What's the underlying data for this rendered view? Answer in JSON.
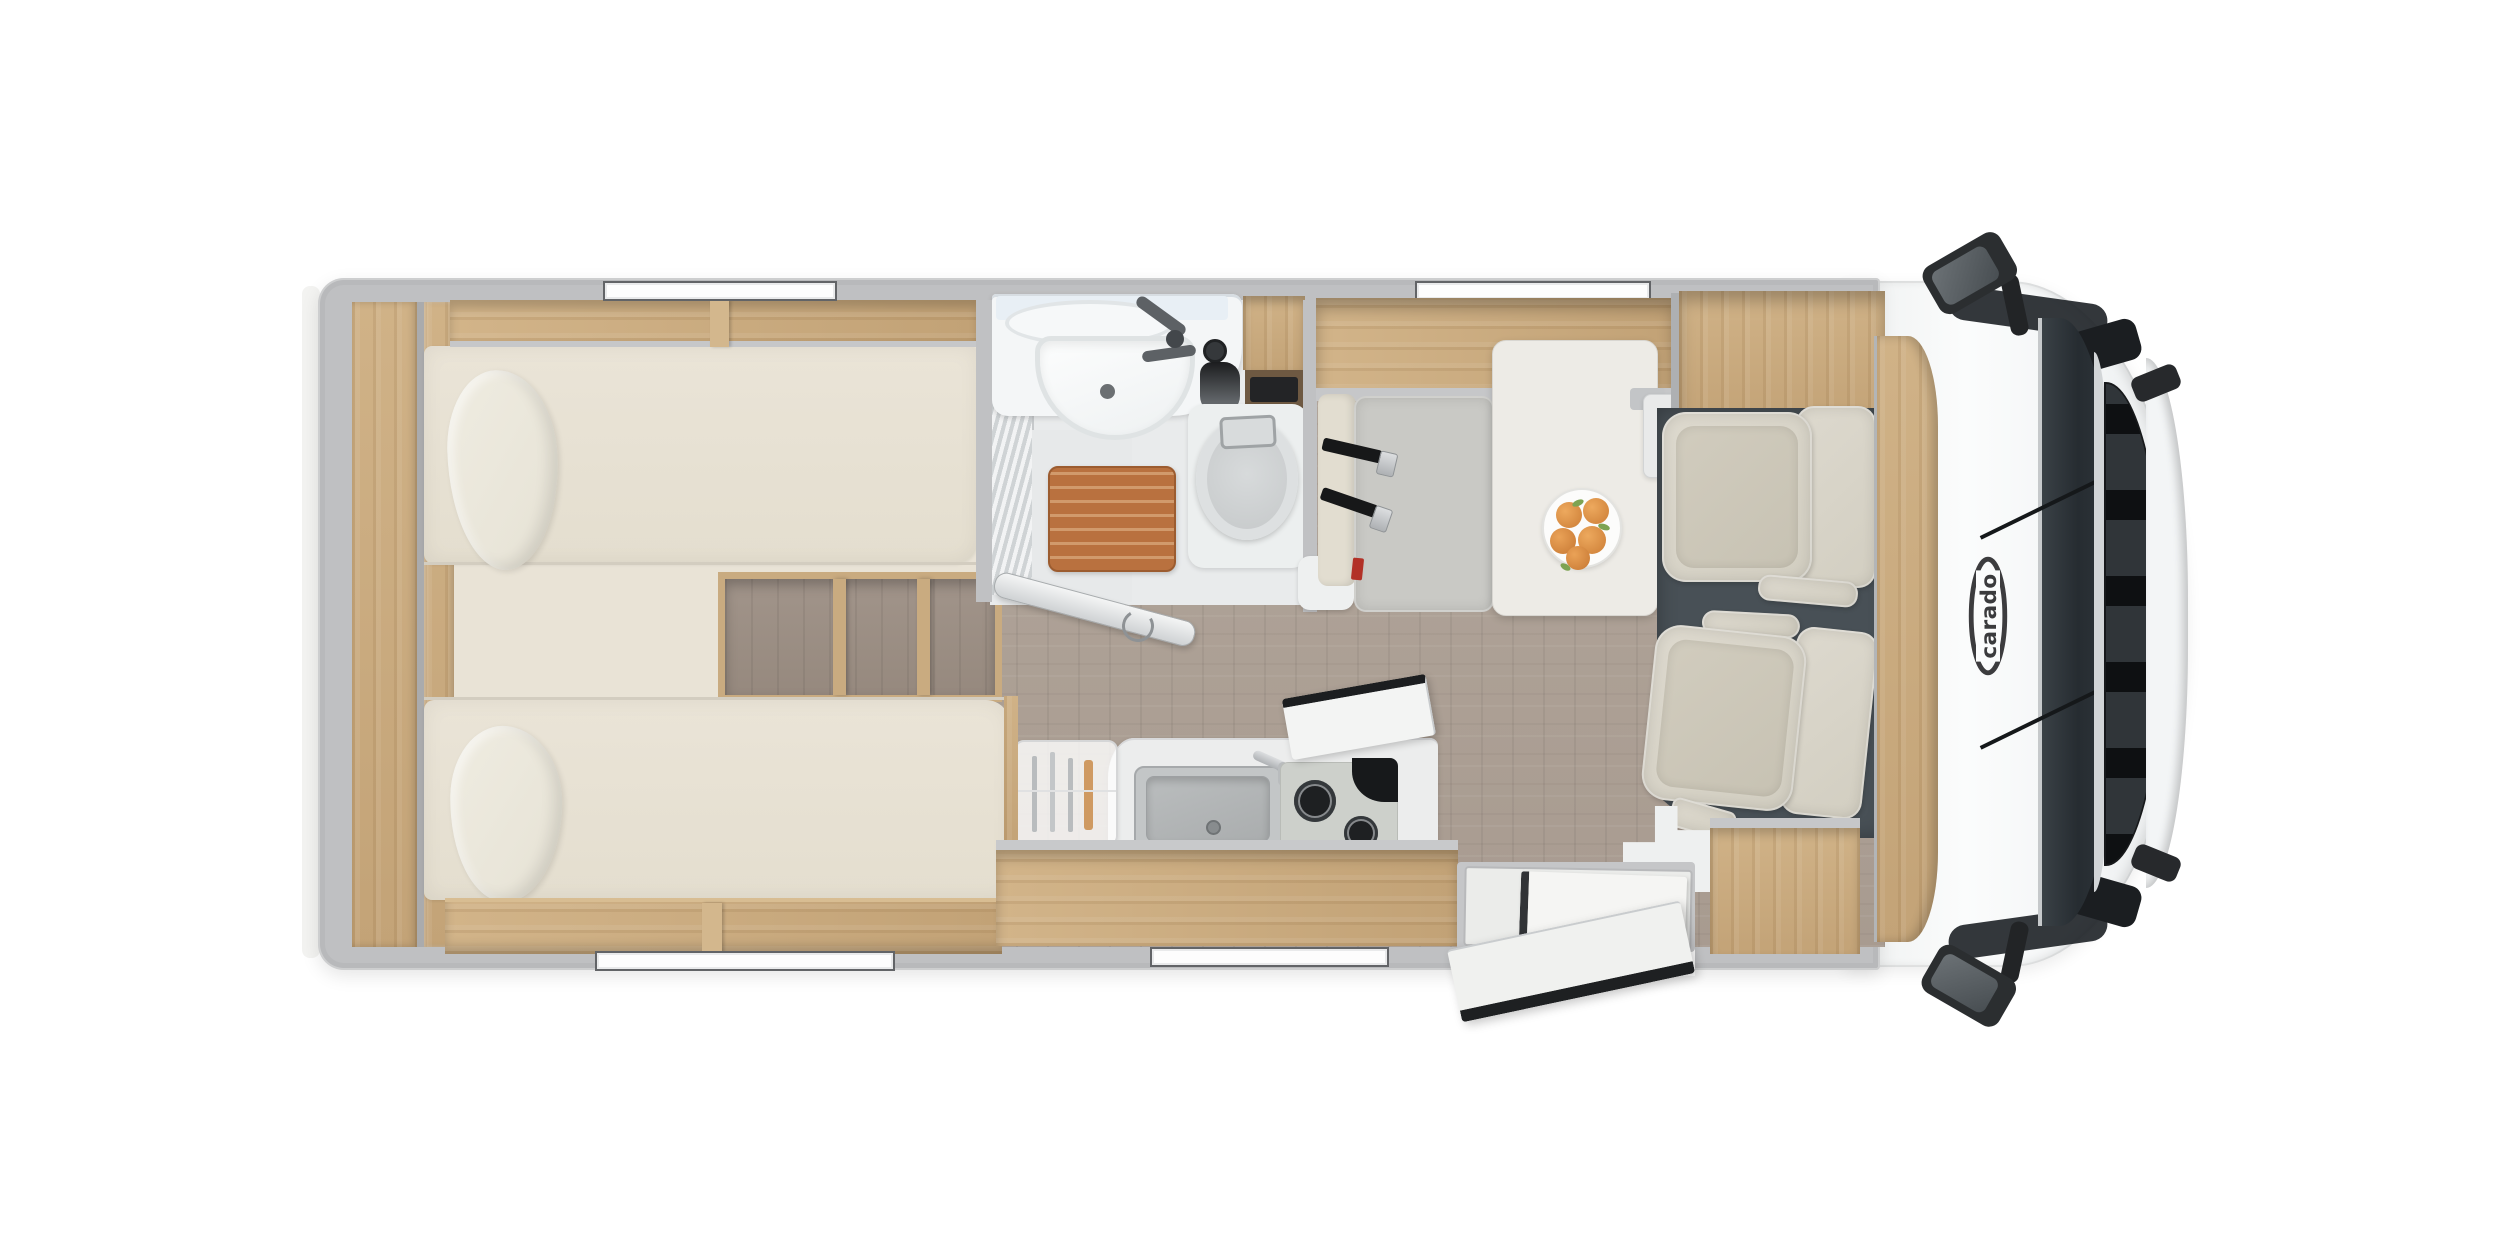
{
  "brand": {
    "logo_text": "carado"
  },
  "scene": {
    "view": "motorhome-floorplan-top-view",
    "windows_top": 2,
    "windows_bottom": 2,
    "single_beds": 2,
    "cab_seats": 2,
    "seatbelt_straps": 2,
    "hob_burners": 2,
    "fruit_count": 5
  },
  "palette": {
    "background": "#ffffff",
    "wall_gray": "#c0c1c3",
    "wood": "#c9aa7f",
    "floor_laminate": "#ab9e93",
    "mattress_cream": "#e8e2d5",
    "cab_floor": "#485056",
    "seat_beige": "#d8d4c8",
    "bench_gray": "#c9c9c5",
    "table_white": "#edebe6",
    "shower_mat_orange": "#b9713f",
    "windshield": "#2b3237",
    "body_white": "#f8fafa",
    "belt_black": "#171819",
    "fruit_orange": "#e0944c",
    "leaf_green": "#7da352",
    "logo_gray": "#3c3c3e"
  }
}
